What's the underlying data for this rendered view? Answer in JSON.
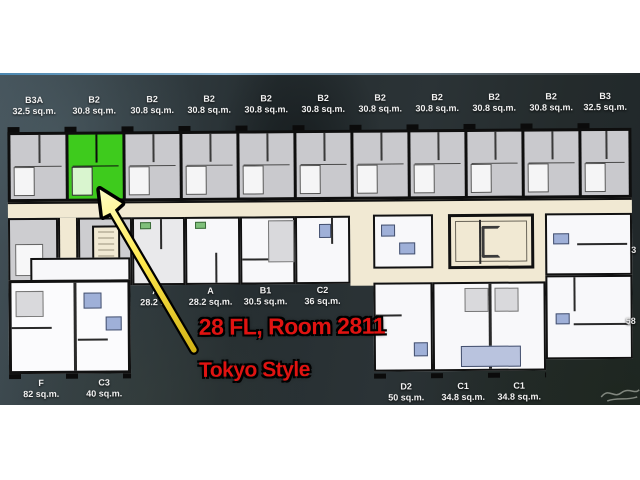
{
  "scene": {
    "kind": "condo-floorplan-photo",
    "highlight_color": "#3ecb1d",
    "annotation_color": "#e01311",
    "arrow_color": "#f2d92a"
  },
  "top_units": [
    {
      "name": "B3A",
      "area": "32.5 sq.m."
    },
    {
      "name": "B2",
      "area": "30.8 sq.m."
    },
    {
      "name": "B2",
      "area": "30.8 sq.m."
    },
    {
      "name": "B2",
      "area": "30.8 sq.m."
    },
    {
      "name": "B2",
      "area": "30.8 sq.m."
    },
    {
      "name": "B2",
      "area": "30.8 sq.m."
    },
    {
      "name": "B2",
      "area": "30.8 sq.m."
    },
    {
      "name": "B2",
      "area": "30.8 sq.m."
    },
    {
      "name": "B2",
      "area": "30.8 sq.m."
    },
    {
      "name": "B2",
      "area": "30.8 sq.m."
    },
    {
      "name": "B3",
      "area": "32.5 sq.m."
    }
  ],
  "mid_units": [
    {
      "name": "A",
      "area": "28.2 sq"
    },
    {
      "name": "A",
      "area": "28.2 sq.m."
    },
    {
      "name": "B1",
      "area": "30.5 sq.m."
    },
    {
      "name": "C2",
      "area": "36 sq.m."
    }
  ],
  "bottom_left_units": [
    {
      "name": "F",
      "area": "82 sq.m."
    },
    {
      "name": "C3",
      "area": "40 sq.m."
    }
  ],
  "bottom_right_units": [
    {
      "name": "D2",
      "area": "50 sq.m."
    },
    {
      "name": "C1",
      "area": "34.8 sq.m."
    },
    {
      "name": "C1",
      "area": "34.8 sq.m."
    }
  ],
  "edge_fragments": {
    "upper": "3",
    "lower": "58"
  },
  "annotation": {
    "line1": "28 FL, Room 2811",
    "line2": "Tokyo Style"
  },
  "highlighted_unit": {
    "name": "B2",
    "area": "30.8 sq.m.",
    "position": "second-from-left-top-row"
  }
}
